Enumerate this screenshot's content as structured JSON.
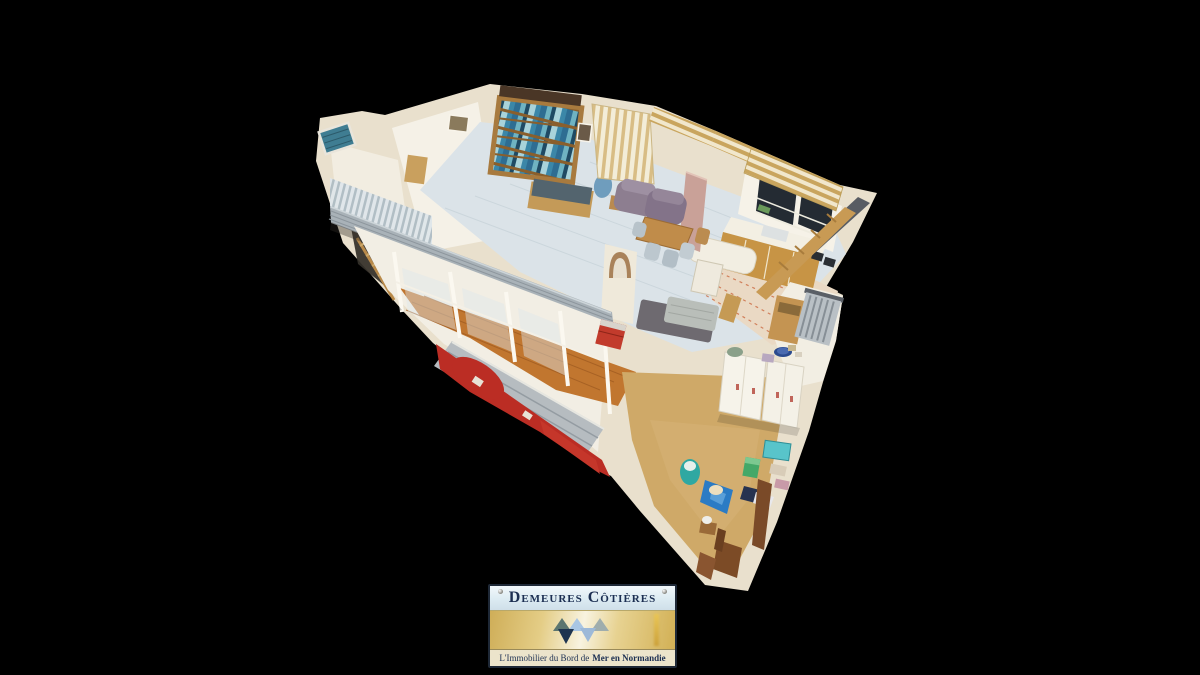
{
  "canvas": {
    "width": 1200,
    "height": 675,
    "background_color": "#000000"
  },
  "scene": {
    "kind": "3d-dollhouse-cutaway-view",
    "palette": {
      "wall_cream": "#e9e0cd",
      "wall_white": "#f5f1e7",
      "carpet_grey_blue": "#dbe3e8",
      "wood_floor_orange": "#c1762f",
      "kitchen_floor_cream": "#ead9c4",
      "workshop_floor_tan": "#cfa968",
      "facade_red": "#bb2d24",
      "deck_grey": "#a9b2b8",
      "bookshelf_wood": "#a87a3e",
      "awning_stripe_beige": "#c9a55e",
      "armchair_mauve": "#8d7e90",
      "partition_pink": "#c9a198",
      "accent_teal": "#2fa8a2",
      "accent_blue": "#2b7bc4"
    }
  },
  "plaque": {
    "title": "Demeures Côtières",
    "tagline_prefix": "L'Immobilier du Bord de",
    "tagline_emphasis": "Mer en Normandie",
    "colors": {
      "text_navy": "#1c2f52",
      "header_top": "#f2f8fb",
      "header_bottom": "#cfdfe9",
      "body_gold": "#d9bc6b",
      "body_highlight": "#f8f3e0",
      "footer_beige": "#ece4cb",
      "border_dark": "#1e2836",
      "triangle_dark_teal": "#5c7670",
      "triangle_light_blue": "#a9c6e4",
      "triangle_grey": "#9fadad",
      "triangle_navy": "#1e3450",
      "triangle_pale_blue": "#9db9d8"
    }
  }
}
